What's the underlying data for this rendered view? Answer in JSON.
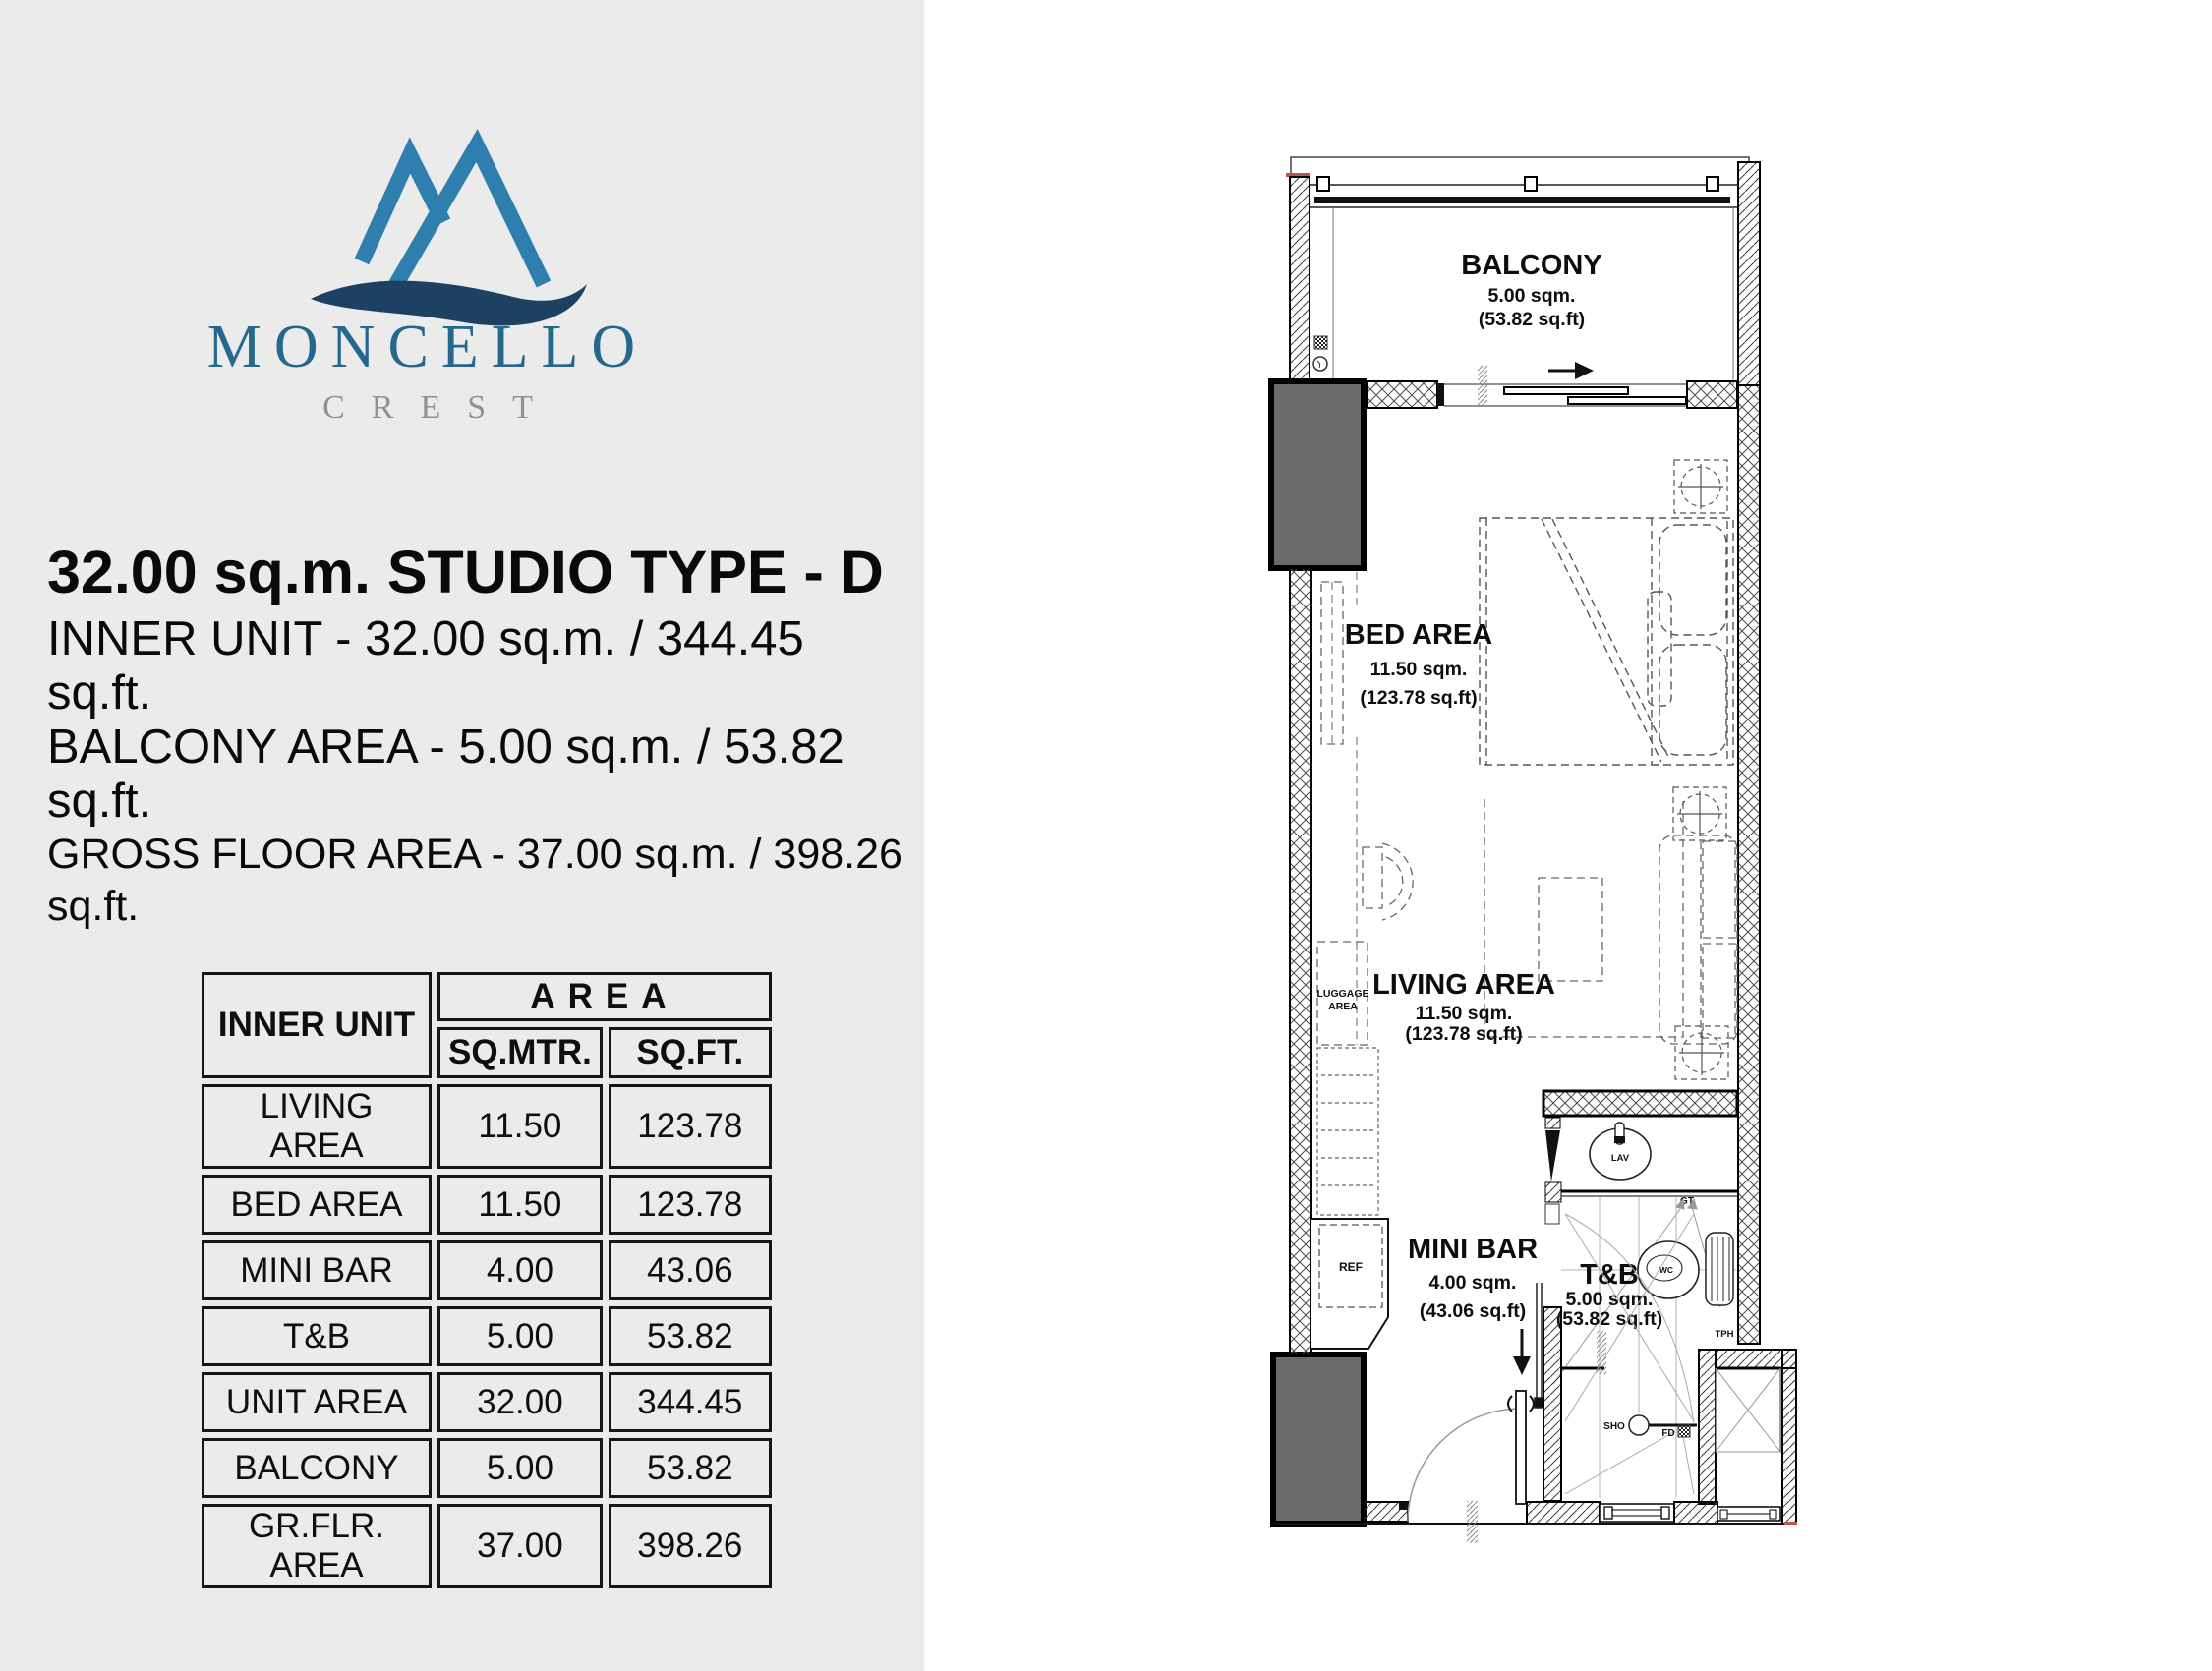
{
  "page": {
    "left_panel_bg": "#ebebeb",
    "right_bg": "#ffffff"
  },
  "logo": {
    "name": "MONCELLO",
    "tagline": "CREST",
    "name_color": "#25688c",
    "tagline_color": "#8d9298",
    "peak_color": "#2e7fae",
    "wave_color": "#1c4163"
  },
  "header": {
    "title": "32.00 sq.m. STUDIO TYPE - D",
    "line1": "INNER UNIT - 32.00 sq.m. / 344.45 sq.ft.",
    "line2": "BALCONY AREA - 5.00 sq.m. / 53.82 sq.ft.",
    "line3": "GROSS FLOOR AREA - 37.00 sq.m. / 398.26 sq.ft."
  },
  "area_table": {
    "row_header": "INNER UNIT",
    "group_header": "AREA",
    "col1": "SQ.MTR.",
    "col2": "SQ.FT.",
    "rows": [
      {
        "label": "LIVING AREA",
        "sqm": "11.50",
        "sqft": "123.78"
      },
      {
        "label": "BED AREA",
        "sqm": "11.50",
        "sqft": "123.78"
      },
      {
        "label": "MINI BAR",
        "sqm": "4.00",
        "sqft": "43.06"
      },
      {
        "label": "T&B",
        "sqm": "5.00",
        "sqft": "53.82"
      },
      {
        "label": "UNIT AREA",
        "sqm": "32.00",
        "sqft": "344.45"
      },
      {
        "label": "BALCONY",
        "sqm": "5.00",
        "sqft": "53.82"
      },
      {
        "label": "GR.FLR. AREA",
        "sqm": "37.00",
        "sqft": "398.26"
      }
    ]
  },
  "floorplan": {
    "balcony": {
      "name": "BALCONY",
      "sqm": "5.00 sqm.",
      "sqft": "(53.82 sq.ft)"
    },
    "bed": {
      "name": "BED AREA",
      "sqm": "11.50 sqm.",
      "sqft": "(123.78 sq.ft)"
    },
    "living": {
      "name": "LIVING AREA",
      "sqm": "11.50 sqm.",
      "sqft": "(123.78 sq.ft)"
    },
    "minibar": {
      "name": "MINI BAR",
      "sqm": "4.00 sqm.",
      "sqft": "(43.06 sq.ft)"
    },
    "tb": {
      "name": "T&B",
      "sqm": "5.00 sqm.",
      "sqft": "(53.82 sq.ft)"
    },
    "labels": {
      "luggage1": "LUGGAGE",
      "luggage2": "AREA",
      "ref": "REF",
      "lav": "LAV",
      "wc": "WC",
      "gt": "GT",
      "tph": "TPH",
      "sho": "SHO",
      "fd": "FD"
    }
  }
}
